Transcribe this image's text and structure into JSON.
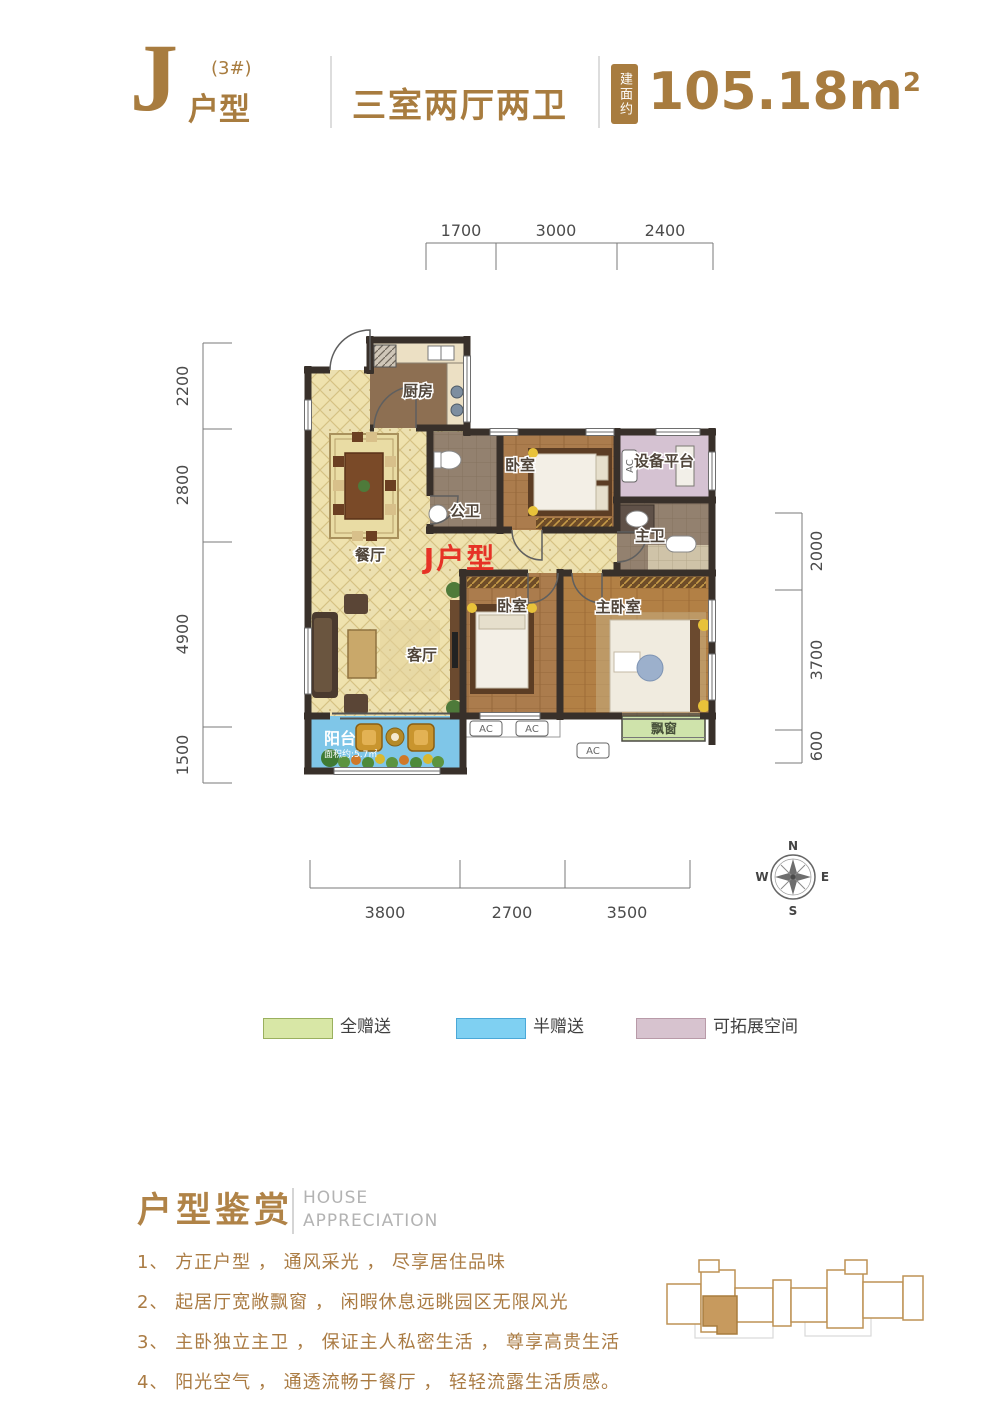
{
  "header": {
    "letter": "J",
    "building": "(3#)",
    "type_label": "户型",
    "rooms_summary": "三室两厅两卫",
    "area_badge": "建面约",
    "area_value": "105.18m",
    "area_sup": "2"
  },
  "plan": {
    "unit_label": "J户型",
    "rooms": {
      "kitchen": "厨房",
      "bath": "公卫",
      "bedroom_top": "卧室",
      "equipment": "设备平台",
      "master_bath": "主卫",
      "dining": "餐厅",
      "living": "客厅",
      "bedroom_bottom": "卧室",
      "master_bedroom": "主卧室",
      "balcony": "阳台",
      "balcony_area": "面积约:5.7㎡",
      "bay_window": "飘窗"
    },
    "ac_label": "AC",
    "compass": {
      "n": "N",
      "e": "E",
      "s": "S",
      "w": "W"
    },
    "dims": {
      "top": [
        "1700",
        "3000",
        "2400"
      ],
      "left": [
        "2200",
        "2800",
        "4900",
        "1500"
      ],
      "right": [
        "2000",
        "3700",
        "600"
      ],
      "bottom": [
        "3800",
        "2700",
        "3500"
      ]
    }
  },
  "legend": {
    "items": [
      {
        "label": "全赠送",
        "color": "#d8e7a6"
      },
      {
        "label": "半赠送",
        "color": "#7fd0f2"
      },
      {
        "label": "可拓展空间",
        "color": "#d7c3cf"
      }
    ]
  },
  "appreciation": {
    "title": "户型鉴赏",
    "subtitle_line1": "HOUSE",
    "subtitle_line2": "APPRECIATION",
    "items": [
      "1、 方正户型 ， 通风采光 ， 尽享居住品味",
      "2、 起居厅宽敞飘窗 ， 闲暇休息远眺园区无限风光",
      "3、 主卧独立主卫 ， 保证主人私密生活 ， 尊享高贵生活",
      "4、 阳光空气 ， 通透流畅于餐厅 ， 轻轻流露生活质感。"
    ]
  },
  "colors": {
    "brand_gold": "#a87c3f",
    "unit_label_red": "#e63226",
    "wall": "#38302a",
    "hall_floor": "#efe2ae",
    "wood_floor": "#ab7c4d",
    "balcony_blue": "#7fc6e8",
    "bay_green": "#cfe3ab",
    "equipment_pink": "#d5c2d2"
  }
}
